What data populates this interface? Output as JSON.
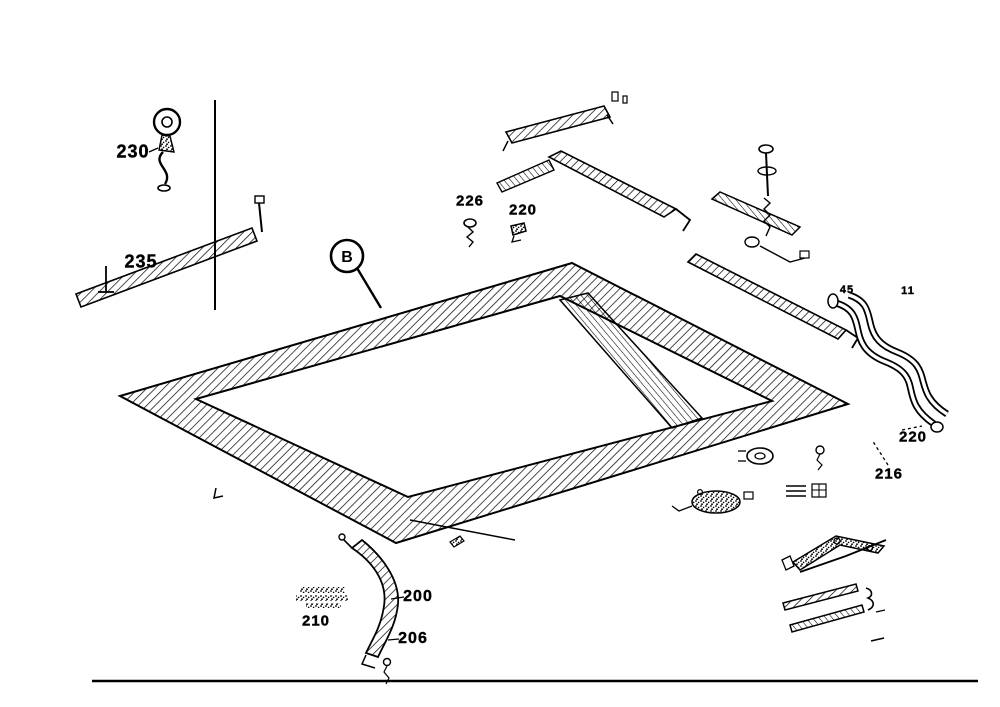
{
  "figure": {
    "type": "exploded-parts-diagram",
    "background_color": "#ffffff",
    "ink_color": "#000000",
    "callout": {
      "letter": "B"
    },
    "labels": [
      {
        "id": "230",
        "text": "230",
        "x": 133,
        "y": 152,
        "size": 18
      },
      {
        "id": "235",
        "text": "235",
        "x": 141,
        "y": 262,
        "size": 18
      },
      {
        "id": "226",
        "text": "226",
        "x": 470,
        "y": 201,
        "size": 15
      },
      {
        "id": "220-top",
        "text": "220",
        "x": 523,
        "y": 210,
        "size": 15
      },
      {
        "id": "45",
        "text": "45",
        "x": 847,
        "y": 290,
        "size": 11
      },
      {
        "id": "11",
        "text": "11",
        "x": 908,
        "y": 291,
        "size": 11
      },
      {
        "id": "220-right",
        "text": "220",
        "x": 913,
        "y": 437,
        "size": 15
      },
      {
        "id": "216",
        "text": "216",
        "x": 889,
        "y": 474,
        "size": 15
      },
      {
        "id": "210",
        "text": "210",
        "x": 316,
        "y": 621,
        "size": 15
      },
      {
        "id": "200",
        "text": "200",
        "x": 418,
        "y": 597,
        "size": 16
      },
      {
        "id": "206",
        "text": "206",
        "x": 413,
        "y": 639,
        "size": 16
      }
    ]
  }
}
